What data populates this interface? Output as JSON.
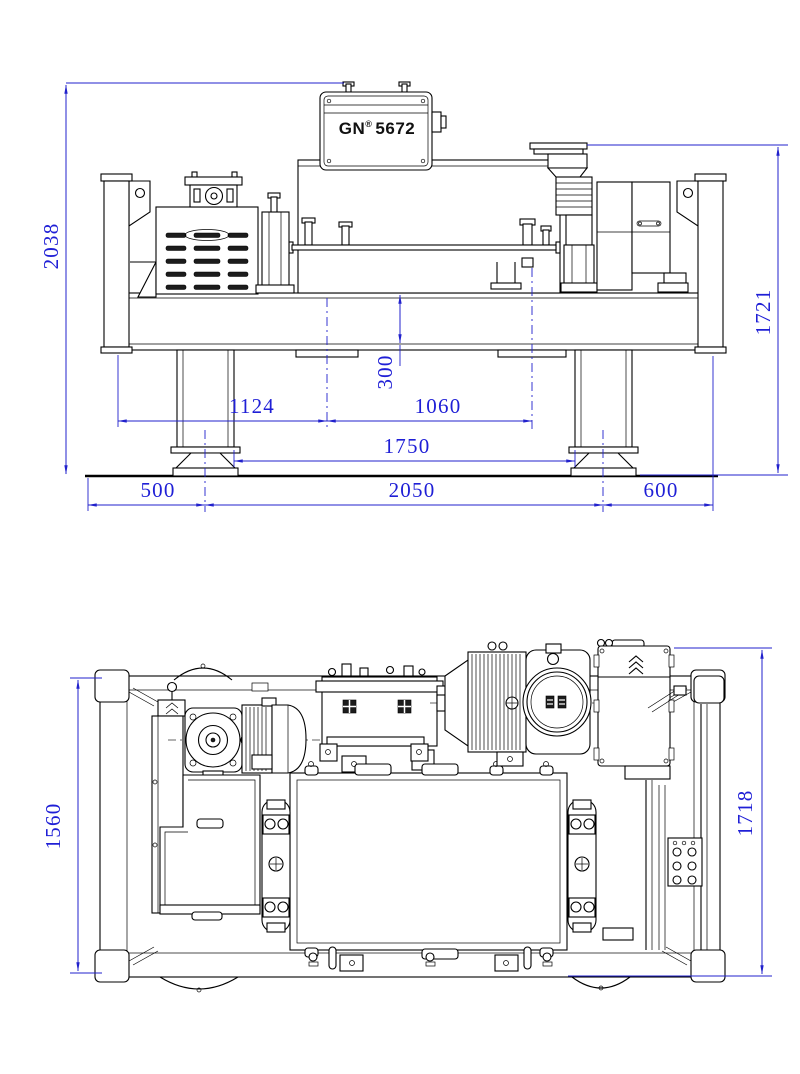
{
  "drawing": {
    "label": {
      "brand": "GN",
      "reg": "®",
      "model": "5672"
    },
    "dims": {
      "d2038": "2038",
      "d1721": "1721",
      "d300": "300",
      "d1124": "1124",
      "d1060": "1060",
      "d1750": "1750",
      "d500": "500",
      "d2050": "2050",
      "d600": "600",
      "d1560": "1560",
      "d1718": "1718"
    },
    "colors": {
      "dimension_lines": "#2121cc",
      "dimension_text": "#1f1fd6",
      "machine_lines": "#000000",
      "background": "#ffffff"
    }
  }
}
